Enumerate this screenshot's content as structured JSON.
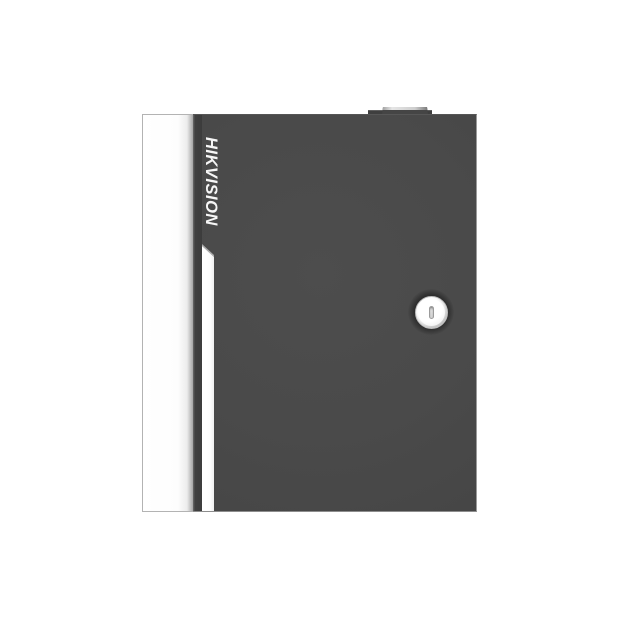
{
  "product": {
    "brand_label": "HIKVISION",
    "description": "Dark gray metal access-controller enclosure with white left side panel, vertical brand logotype, white accent stripe with beveled top, top hinge tab and circular cam lock with vertical keyhole slot",
    "colors": {
      "background": "#ffffff",
      "door_gray": "#4a4a4a",
      "door_left_edge_shadow": "#3c3c3c",
      "panel_white": "#fdfdfd",
      "panel_border": "#b3b3b3",
      "edge_highlight": "#9b9b9b",
      "logo_white": "#f6f6f6",
      "stripe_white": "#ffffff",
      "stripe_bevel_gray": "#ababab",
      "hinge_tab_dark": "#454545",
      "hinge_tab_highlight": "#e6e6e6",
      "lock_face": "#f2f2f2",
      "lock_rim": "#bdbdbd",
      "keyhole_gray": "#d1d1d1"
    },
    "icons": {
      "keyhole": "keyhole-icon"
    }
  }
}
